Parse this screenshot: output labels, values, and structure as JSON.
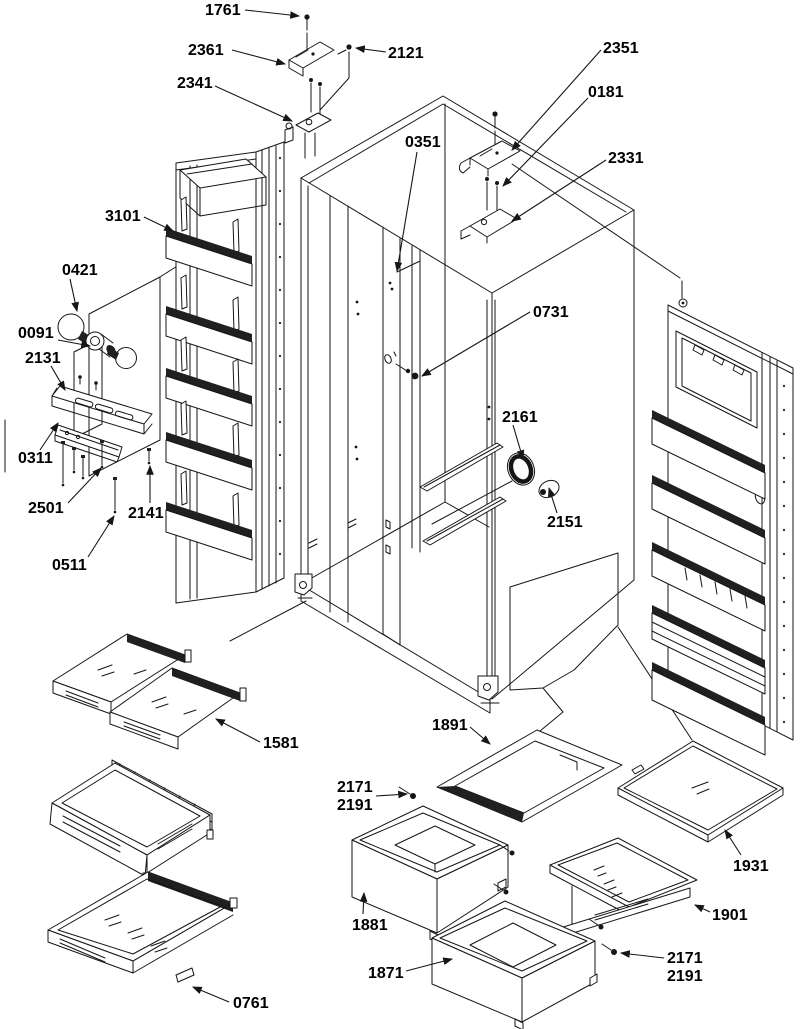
{
  "figure": {
    "type": "exploded-parts-diagram",
    "subject": "side-by-side refrigerator cabinet, doors, hinges, shelves, drawers and lighting",
    "background_color": "#ffffff",
    "ink_color": "#161616"
  },
  "parts": {
    "1761": "1761",
    "2361": "2361",
    "2121": "2121",
    "2341": "2341",
    "2351": "2351",
    "0181": "0181",
    "2331": "2331",
    "0351": "0351",
    "3101": "3101",
    "0421": "0421",
    "0091": "0091",
    "2131": "2131",
    "0311": "0311",
    "2501": "2501",
    "2141": "2141",
    "0511": "0511",
    "0731": "0731",
    "2161": "2161",
    "2151": "2151",
    "1581": "1581",
    "1891": "1891",
    "2171": "2171",
    "2191": "2191",
    "1881": "1881",
    "1871": "1871",
    "1931": "1931",
    "1901": "1901",
    "0761": "0761"
  }
}
